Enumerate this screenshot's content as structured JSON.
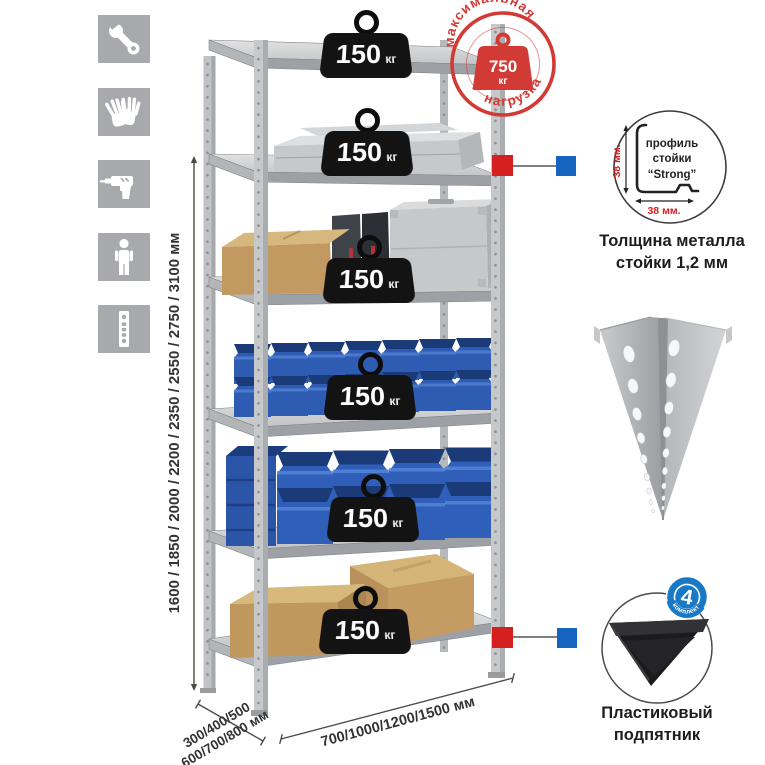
{
  "icons": {
    "items": [
      {
        "icon": "wrench-icon"
      },
      {
        "icon": "gloves-icon"
      },
      {
        "icon": "drill-icon"
      },
      {
        "icon": "person-icon"
      },
      {
        "icon": "rack-post-icon"
      }
    ]
  },
  "dimensions": {
    "height": "1600 / 1850 / 2000 / 2200 / 2350 / 2550 / 2750 / 3100 мм",
    "depth_line1": "300/400/500",
    "depth_line2": "600/700/800 мм",
    "width": "700/1000/1200/1500 мм"
  },
  "rack": {
    "shelves": [
      {
        "load_value": "150",
        "load_unit": "кг"
      },
      {
        "load_value": "150",
        "load_unit": "кг"
      },
      {
        "load_value": "150",
        "load_unit": "кг"
      },
      {
        "load_value": "150",
        "load_unit": "кг"
      },
      {
        "load_value": "150",
        "load_unit": "кг"
      },
      {
        "load_value": "150",
        "load_unit": "кг"
      }
    ]
  },
  "max_load_stamp": {
    "arc_top": "максимальная",
    "arc_bottom": "нагрузка",
    "value": "750",
    "unit": "кг"
  },
  "post_profile": {
    "dim_vertical": "38 мм.",
    "dim_horizontal": "38 мм.",
    "label_line1": "профиль",
    "label_line2": "стойки",
    "label_line3": "“Strong”",
    "caption_line1": "Толщина металла",
    "caption_line2": "стойки 1,2 мм"
  },
  "foot": {
    "badge_count": "4",
    "badge_arc": "в комплекте",
    "caption_line1": "Пластиковый",
    "caption_line2": "подпятник"
  },
  "colors": {
    "stamp_red": "#d23b35",
    "marker_red": "#d5201f",
    "marker_blue": "#1565c0",
    "bin_blue": "#2e5cb2",
    "icon_gray": "#a7a9ac"
  }
}
